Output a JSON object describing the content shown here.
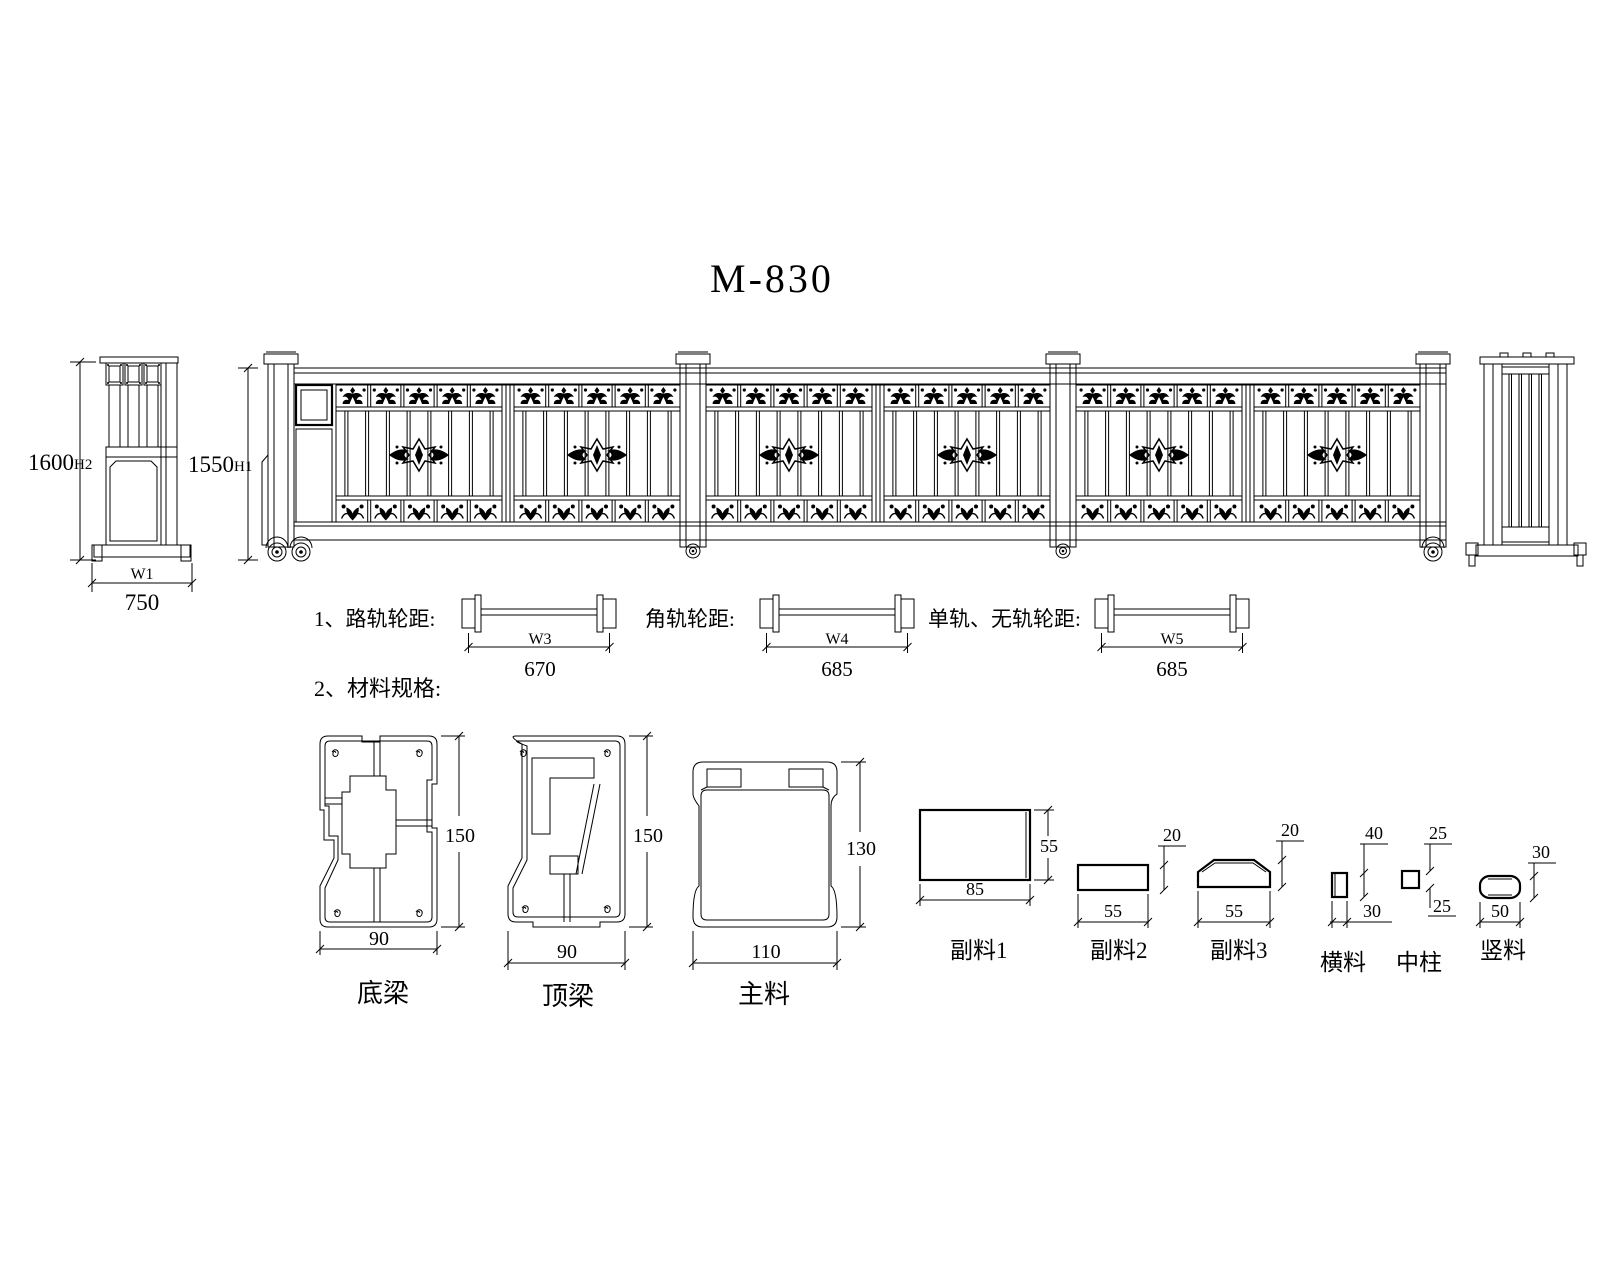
{
  "title": "M-830",
  "front_column_view": {
    "height_value": "1600",
    "height_tag": "H2",
    "width_tag": "W1",
    "width_value": "750"
  },
  "gate_elevation": {
    "height_value": "1550",
    "height_tag": "H1"
  },
  "wheel_spacing": {
    "item1": {
      "label": "1、路轨轮距:",
      "tag": "W3",
      "value": "670"
    },
    "item2": {
      "label": "角轨轮距:",
      "tag": "W4",
      "value": "685"
    },
    "item3": {
      "label": "单轨、无轨轮距:",
      "tag": "W5",
      "value": "685"
    }
  },
  "materials": {
    "heading": "2、材料规格:",
    "profiles": [
      {
        "name": "底梁",
        "width": "90",
        "height": "150"
      },
      {
        "name": "顶梁",
        "width": "90",
        "height": "150"
      },
      {
        "name": "主料",
        "width": "110",
        "height": "130"
      },
      {
        "name": "副料1",
        "width": "85",
        "height": "55"
      },
      {
        "name": "副料2",
        "width": "55",
        "height": "20"
      },
      {
        "name": "副料3",
        "width": "55",
        "height": "20"
      },
      {
        "name": "横料",
        "width": "30",
        "height": "40"
      },
      {
        "name": "中柱",
        "width": "25",
        "height": "25"
      },
      {
        "name": "竖料",
        "width": "50",
        "height": "30"
      }
    ]
  }
}
